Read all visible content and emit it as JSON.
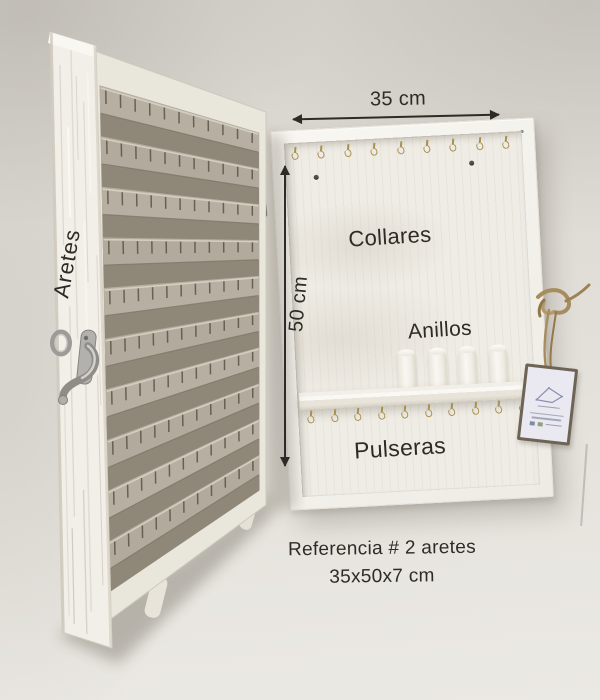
{
  "annotations": {
    "door_label": "Aretes",
    "width_label": "35 cm",
    "height_label": "50 cm",
    "necklaces_label": "Collares",
    "rings_label": "Anillos",
    "bracelets_label": "Pulseras",
    "caption_line1": "Referencia # 2 aretes",
    "caption_line2": "35x50x7 cm"
  },
  "organizer": {
    "top_hook_count": 9,
    "bracelet_hook_count": 10,
    "ring_post_count": 4,
    "earring_slat_rows": 10,
    "notches_per_slat": 11
  },
  "colors": {
    "wall": "#e1ded8",
    "cabinet": "#f4f2ec",
    "panel": "#efece5",
    "slat": "#b7b0a2",
    "board": "#f2efe8",
    "hook_gold": "#a8904f",
    "ink": "#2e2b27",
    "hinge": "#2a2620",
    "metal": "#aaa8a4",
    "twine": "#a78c5e",
    "tag": "#eae8f1"
  }
}
